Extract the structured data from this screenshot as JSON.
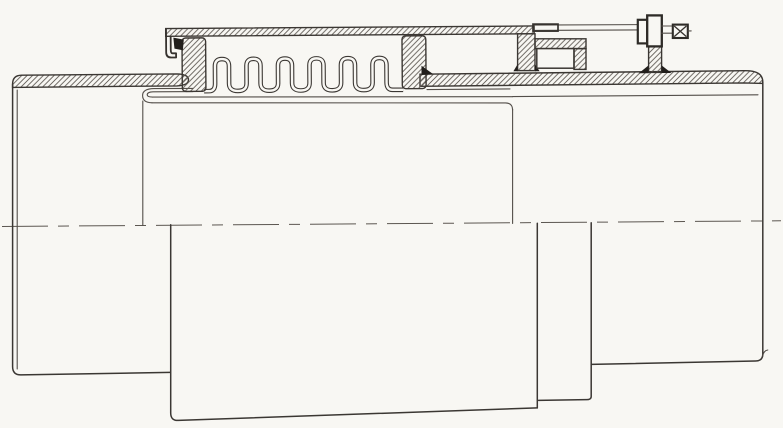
{
  "canvas": {
    "width": 783,
    "height": 428
  },
  "colors": {
    "paper": "#f8f7f3",
    "line": "#3b3733",
    "line_thin": "#534e49",
    "hatch_line": "#5b5650",
    "weld": "#221f1c",
    "centerline": "#5c5751"
  },
  "drawing": {
    "kind": "scanned engineering cross-section line drawing",
    "subject": "axial bellows expansion joint between two pipe ends",
    "text_labels": [],
    "components": [
      {
        "name": "left-pipe",
        "style": "sectioned wall, hatched, flared end"
      },
      {
        "name": "bellows",
        "style": "double-walled corrugation",
        "convolutions": 6
      },
      {
        "name": "left-collar",
        "style": "hatched reinforcing collar"
      },
      {
        "name": "right-collar",
        "style": "hatched reinforcing collar"
      },
      {
        "name": "external-cover-sleeve",
        "style": "hatched cover plate with down-turned lip, large cylinder below"
      },
      {
        "name": "internal-liner-sleeve",
        "style": "thin telescoping sleeve with rolled left lip"
      },
      {
        "name": "right-pipe",
        "style": "sectioned wall, hatched, rounded outer end"
      },
      {
        "name": "limit-bracket",
        "style": "hatched lug, top plate and stop block on right pipe"
      },
      {
        "name": "tie-rod",
        "style": "horizontal rod with two nut plates, hatched support post, cross-hatched rod end"
      },
      {
        "name": "weld-fillets",
        "style": "solid black triangles"
      },
      {
        "name": "centerline",
        "style": "chain dashed axis line"
      }
    ]
  }
}
